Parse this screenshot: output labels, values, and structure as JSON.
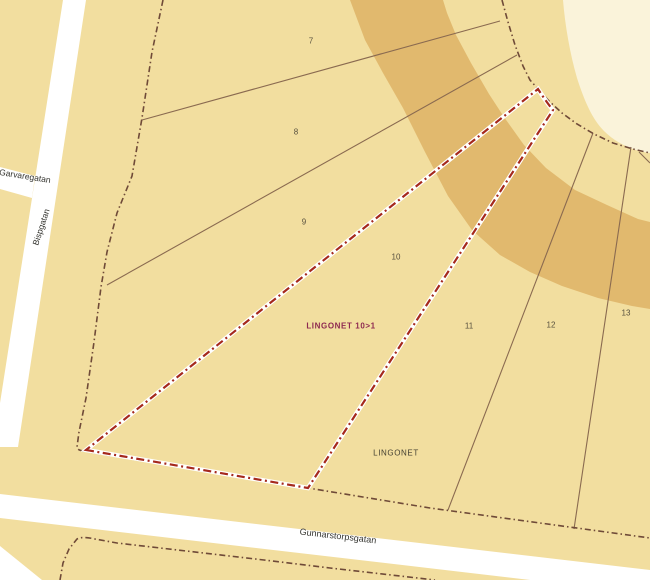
{
  "map": {
    "type": "cadastral-map",
    "streets": [
      {
        "name": "Garvaregatan"
      },
      {
        "name": "Bispgatan"
      },
      {
        "name": "Gunnarstorpsgatan"
      }
    ],
    "parcels": [
      {
        "number": "7"
      },
      {
        "number": "8"
      },
      {
        "number": "9"
      },
      {
        "number": "10"
      },
      {
        "number": "11"
      },
      {
        "number": "12"
      },
      {
        "number": "13"
      }
    ],
    "properties": [
      {
        "label": "LINGONET 10>1"
      },
      {
        "label": "LINGONET"
      }
    ],
    "colors": {
      "parcel_beige": "#F2DE9F",
      "ring_band_tan": "#E1B96E",
      "inner_cream": "#FAF3DA",
      "street_white": "#FFFFFF",
      "parcel_line_brown": "#8A6A50",
      "block_boundary_brown": "#6F4A38",
      "highlight_boundary_red": "#A5291D",
      "property_label_maroon": "#8E2950"
    }
  }
}
